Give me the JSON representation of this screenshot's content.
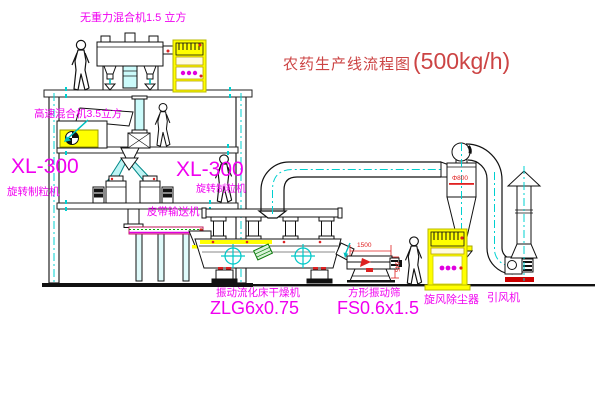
{
  "title": {
    "name": "农药生产线流程图",
    "capacity": "(500kg/h)"
  },
  "labels": {
    "gravity_free_mixer": "无重力混合机1.5 立方",
    "high_speed_mixer": "高速混合机3.5立方",
    "granulator_left_model": "XL-300",
    "granulator_left_name": "旋转制粒机",
    "granulator_center_model": "XL-300",
    "granulator_center_name": "旋转制粒机",
    "belt_conveyor": "皮带输送机",
    "dryer_name": "振动流化床干燥机",
    "dryer_model": "ZLG6x0.75",
    "screen_name": "方形振动筛",
    "screen_model": "FS0.6x1.5",
    "cyclone": "旋风除尘器",
    "induced_draft_fan": "引风机"
  },
  "dimensions": {
    "cyclone_diameter": "Φ800",
    "screen_length": "1500",
    "screen_outlet_height": "945"
  },
  "colors": {
    "label_magenta": "#f000f0",
    "title_red": "#cc4444",
    "dimension_red": "#e02020",
    "centerline_cyan": "#00d0d0",
    "cabinet_yellow": "#ffff00",
    "line_black": "#1a1a1a",
    "background": "#ffffff"
  }
}
